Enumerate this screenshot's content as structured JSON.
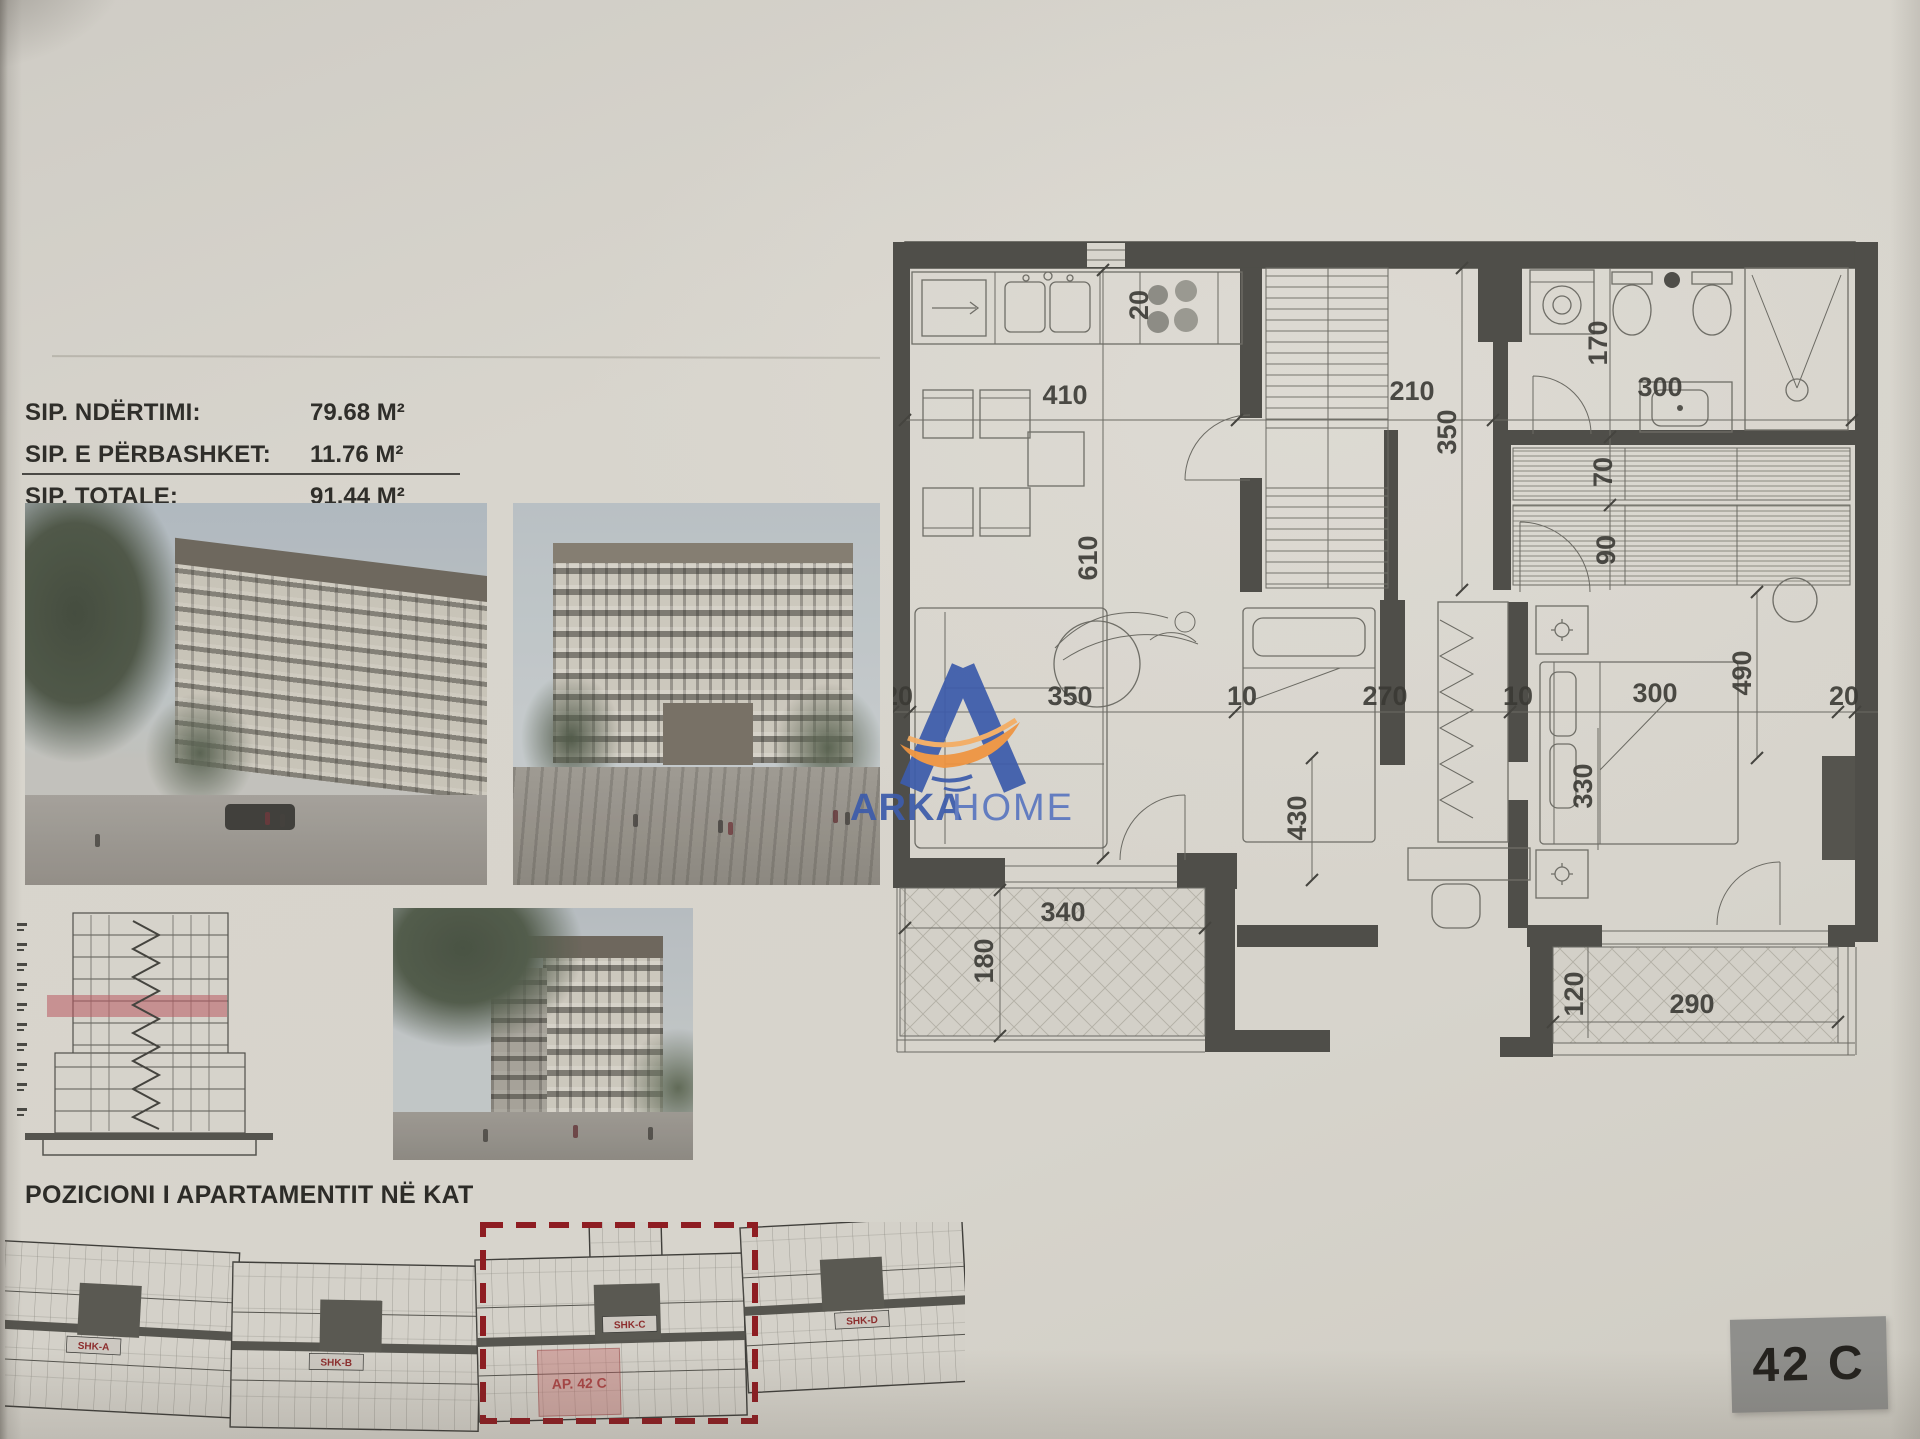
{
  "info_panel": {
    "rows": [
      {
        "label": "SIP. NDËRTIMI:",
        "value": "79.68 M²"
      },
      {
        "label": "SIP. E PËRBASHKET:",
        "value": "11.76 M²"
      },
      {
        "label": "SIP. TOTALE:",
        "value": "91.44 M²"
      }
    ]
  },
  "logo": {
    "brand_bold": "ARKA",
    "brand_light": "HOME",
    "colors": {
      "blue": "#3d5cab",
      "light_blue": "#5b77c0",
      "orange": "#ef9440"
    }
  },
  "floor_plan": {
    "dims": {
      "kitchen_w": "410",
      "hall_w": "210",
      "bath_w": "300",
      "stove": "20",
      "laundry_h": "170",
      "closet1": "70",
      "closet2": "90",
      "living_h": "610",
      "hall_h": "350",
      "master_h": "490",
      "left_off": "20",
      "living_w": "350",
      "gap1": "10",
      "bed2_w": "270",
      "gap2": "10",
      "master_w": "300",
      "right_off": "20",
      "bed2_h": "430",
      "master_bed": "330",
      "balc1_w": "340",
      "balc1_h": "180",
      "balc2_h": "120",
      "balc2_w": "290"
    }
  },
  "position_section": {
    "heading": "POZICIONI I APARTAMENTIT NË KAT",
    "stairs": [
      "SHK-A",
      "SHK-B",
      "SHK-C",
      "SHK-D"
    ],
    "apartment": "AP. 42 C"
  },
  "unit_badge": "42 C"
}
